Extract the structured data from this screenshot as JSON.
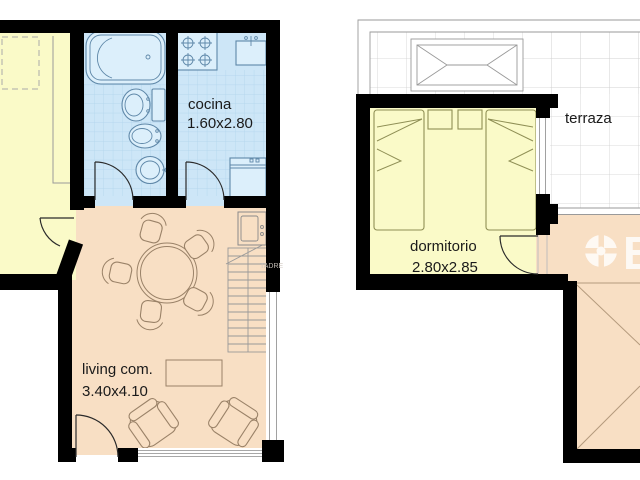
{
  "floor_plan": {
    "lower": {
      "kitchen": {
        "label": "cocina",
        "size": "1.60x2.80"
      },
      "living": {
        "label": "living com.",
        "size": "3.40x4.10"
      }
    },
    "upper": {
      "terrace": {
        "label": "terraza"
      },
      "bedroom": {
        "label": "dormitorio",
        "size": "2.80x2.85"
      }
    }
  },
  "watermark": {
    "partial_letter": "B",
    "faint_text": "TADRE"
  },
  "colors": {
    "wall": "#000000",
    "bedroom_fill": "#FAFAC8",
    "wet_room_fill": "#CDE6F7",
    "living_fill": "#F8DFC4",
    "tile_line": "#AFD3EC",
    "terrace_grid": "#CFCFCF",
    "furniture_outline": "#9A8268",
    "fixture_outline": "#5E87A8",
    "label_text": "#1A1A1A"
  }
}
